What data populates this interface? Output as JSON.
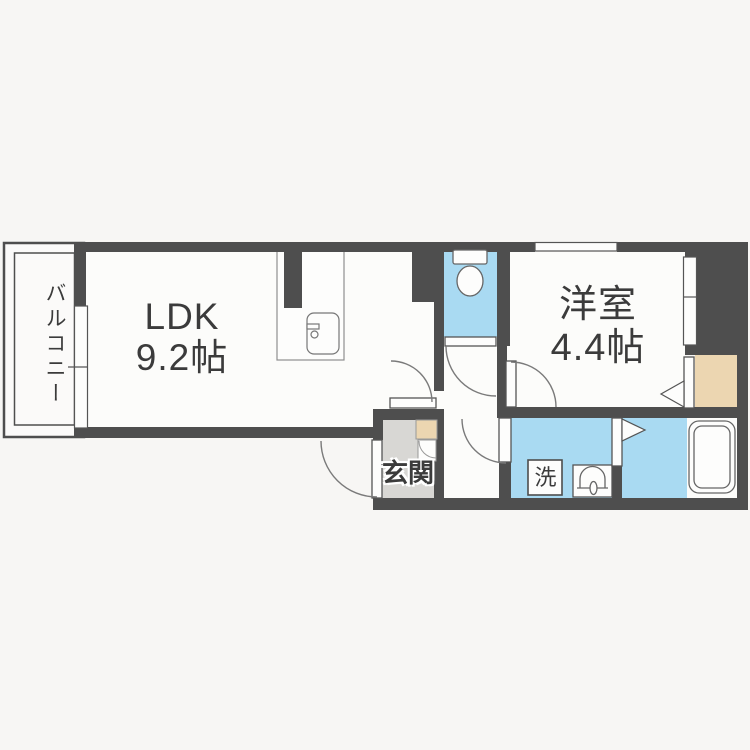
{
  "plan": {
    "type": "floorplan",
    "labels": {
      "balcony": "バルコニー",
      "ldk_name": "LDK",
      "ldk_area": "9.2帖",
      "western_room_name": "洋室",
      "western_room_area": "4.4帖",
      "entrance": "玄関",
      "laundry": "洗"
    },
    "rooms": [
      {
        "id": "ldk",
        "label": "LDK",
        "size": "9.2帖",
        "floor_color": "white"
      },
      {
        "id": "western-room",
        "label": "洋室",
        "size": "4.4帖",
        "floor_color": "white"
      },
      {
        "id": "balcony",
        "label": "バルコニー",
        "floor_color": "white"
      },
      {
        "id": "entrance",
        "label": "玄関",
        "floor_color": "gray"
      },
      {
        "id": "toilet",
        "label": "",
        "floor_color": "blue"
      },
      {
        "id": "washroom",
        "label": "洗",
        "floor_color": "blue"
      },
      {
        "id": "bathroom",
        "label": "",
        "floor_color": "blue"
      },
      {
        "id": "closet",
        "label": "",
        "floor_color": "beige"
      }
    ],
    "fixtures": [
      "toilet-icon",
      "kitchen-sink-icon",
      "washbasin-icon",
      "bathtub-icon",
      "washing-machine-space",
      "shoe-cabinet"
    ],
    "colors": {
      "background": "#f7f6f4",
      "wall": "#4e4e4e",
      "floor": "#fcfcfa",
      "wet_area": "#a9daf2",
      "entrance_floor": "#d8d7d4",
      "closet": "#ecd6b1",
      "text": "#3b3b3b"
    }
  }
}
